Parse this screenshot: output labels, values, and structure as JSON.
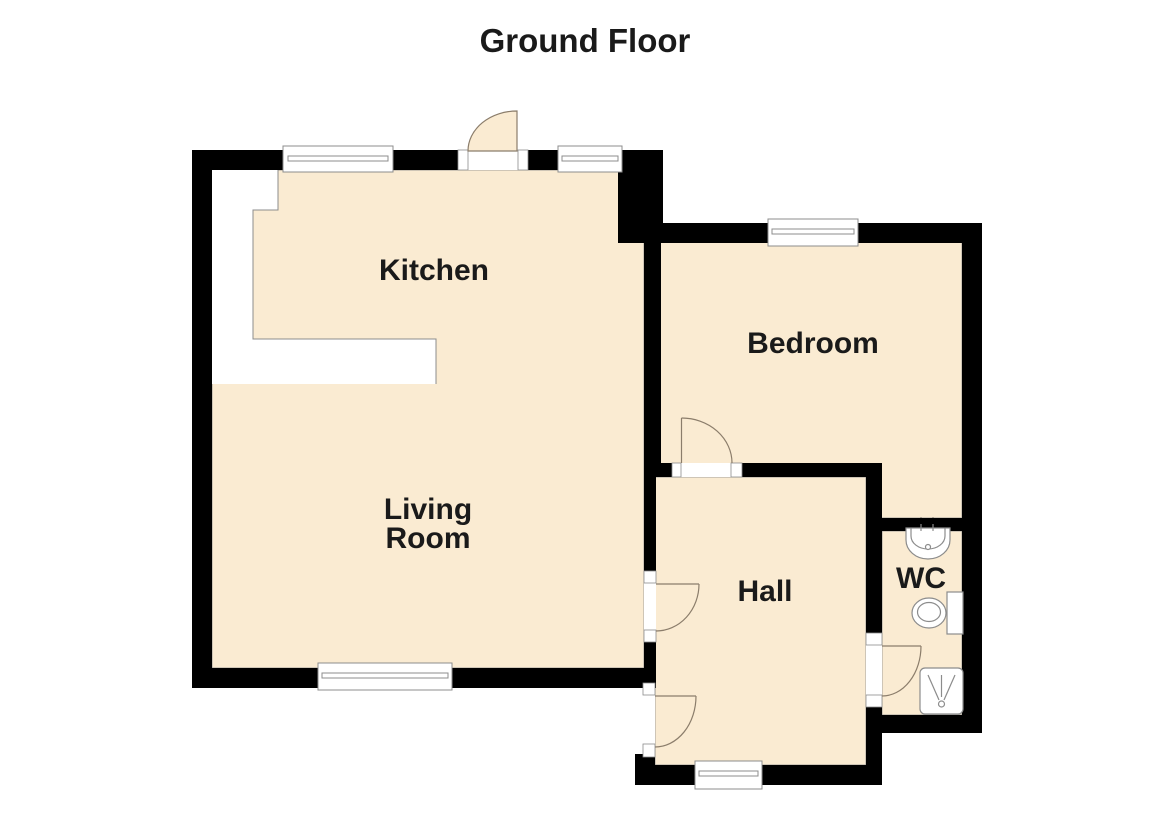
{
  "title": "Ground Floor",
  "rooms": {
    "kitchen": {
      "label": "Kitchen"
    },
    "bedroom": {
      "label": "Bedroom"
    },
    "living_room": {
      "label_line1": "Living",
      "label_line2": "Room"
    },
    "hall": {
      "label": "Hall"
    },
    "wc": {
      "label": "WC"
    }
  },
  "icons": {
    "sink": "sink-icon",
    "toilet": "toilet-icon",
    "shower": "shower-tray-icon",
    "window": "window-icon",
    "door": "door-swing-icon"
  },
  "colors": {
    "background": "#FFFFFF",
    "floor": "#FAEBD2",
    "wall": "#000000",
    "line": "#8C8C8C",
    "arc": "#8B7D6B",
    "text": "#1A1A1A"
  }
}
